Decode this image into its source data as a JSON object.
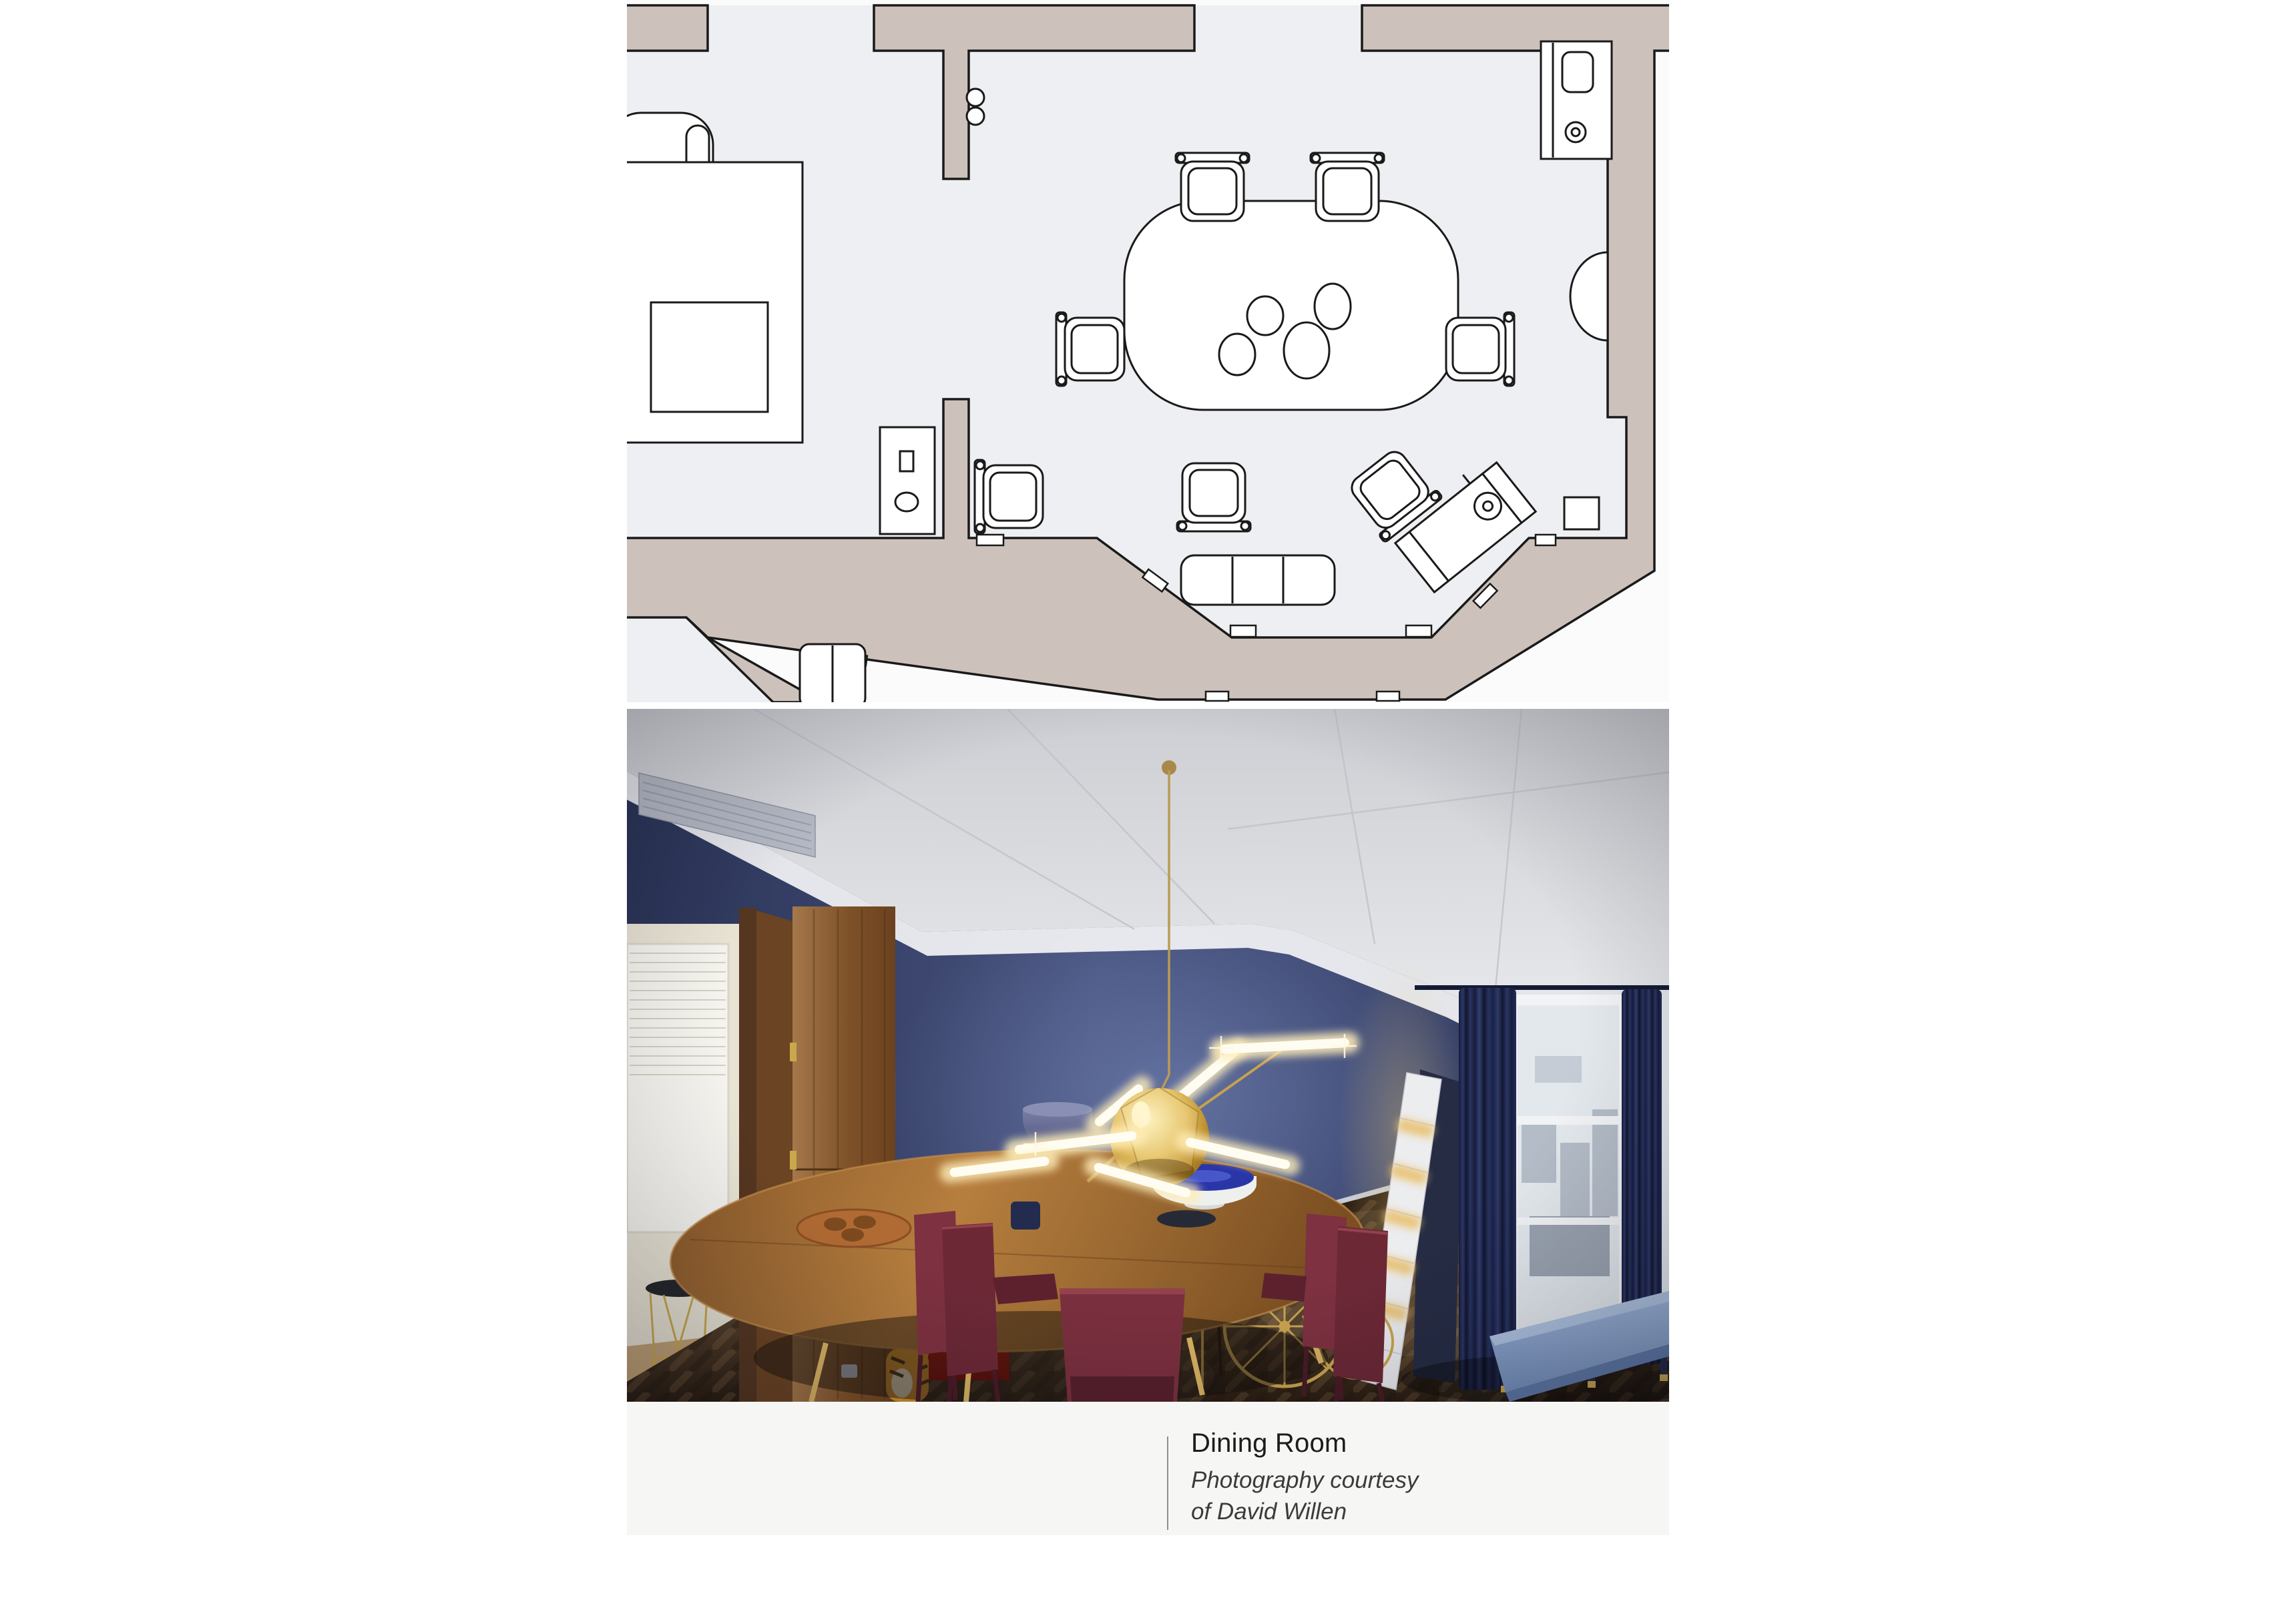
{
  "caption": {
    "title": "Dining Room",
    "credit_line_1": "Photography courtesy",
    "credit_line_2": "of David Willen"
  },
  "floor_plan": {
    "description": "Top-view architectural floor plan of the dining room",
    "furniture": [
      "armchair",
      "rug",
      "side-table",
      "dining-table",
      "dining-chairs",
      "window-seat-bench",
      "drinks-cabinet",
      "radiator",
      "bar-cart",
      "occasional-table",
      "wall-cabinet",
      "adjacent-room-bench"
    ],
    "table_plate_count": 4,
    "dining_chair_count": 7
  },
  "photo": {
    "description": "Dining room with dark blue walls, white coffered ceiling, brass branch chandelier with gold orb, oval wood dining table, burgundy leather chairs, red lacquered cabinet, open walnut door, zigzag illuminated shelf, bay window with navy curtains, brass bar cart, light blue bench and dark herringbone parquet floor"
  },
  "colors": {
    "plan-wall": "#cdc2bb",
    "plan-floor": "#edeff2",
    "plan-line": "#1a1a1a",
    "plan-bg": "#fbfbfb",
    "photo-wall-blue": "#3b4770",
    "photo-ceiling": "#e9eaee",
    "photo-table-wood": "#a06c35",
    "photo-chair-burgundy": "#6d2836",
    "photo-red-cabinet": "#b2251a",
    "photo-curtain-navy": "#1c2449",
    "photo-brass": "#c9a44f",
    "photo-bench-blue": "#8aa4cd",
    "photo-door-wood": "#8a5e33",
    "caption-bg": "#f6f6f4",
    "caption-rule": "#8e8e8e",
    "caption-title-color": "#1c1c1c",
    "caption-credit-color": "#3b3b3b"
  }
}
